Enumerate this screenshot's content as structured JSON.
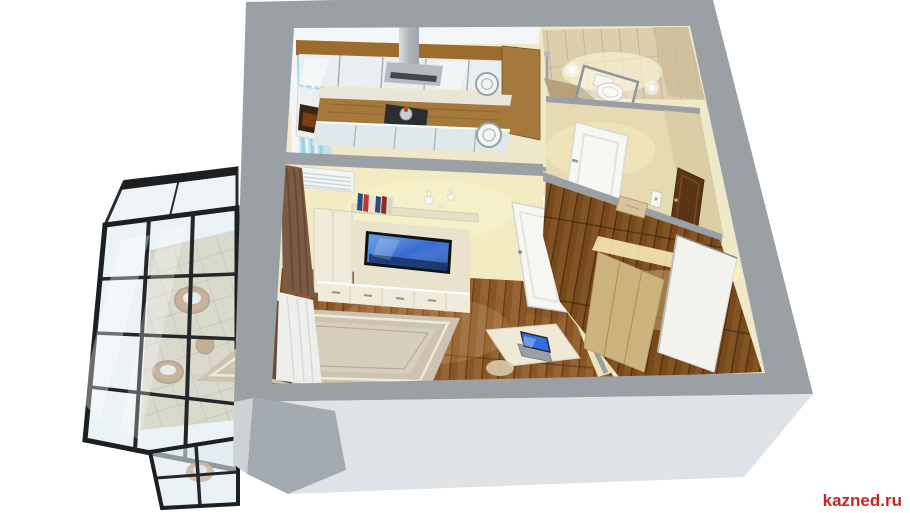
{
  "image": {
    "alt": "3D isometric cutaway render of a one-room apartment floor plan with kitchen, bathroom, hallway, living room and glazed balcony"
  },
  "watermark": {
    "text": "kazned.ru",
    "color": "#c5271d"
  },
  "palette": {
    "background": "#ffffff",
    "wall_top": "#9ba0a4",
    "wall_side": "#dfe3e5",
    "wall_side_mid": "#ccd2d5",
    "wall_side_dark": "#a4abb0",
    "interior_base": "#efe8c9",
    "living_wall": "#f3ecc3",
    "hall_wall": "#e6dab3",
    "floor_living": "#8a5526",
    "floor_hall": "#774819",
    "rug": "#cec3b0",
    "rug_inner": "#d8cec0",
    "cabinet_wood": "#9c6b2e",
    "counter_wood": "#a5783c",
    "cabinet_cream": "#f1ebdb",
    "unit_cream": "#e9e2cc",
    "steel": "#b4bcc0",
    "tv_screen": "#2a63cf",
    "laptop_screen": "#2f6fe0",
    "door_white": "#f7f7f4",
    "door_brown": "#5a3417",
    "wardrobe_beige": "#cdb47c",
    "wardrobe_white": "#f3f3ee",
    "curtain_brown": "#7d5a43",
    "curtain_white": "#edefed",
    "curtain_blue": "#bfe2ee",
    "bathroom_tile": "#ddcfae",
    "bathroom_floor": "#b29b74",
    "toilet_white": "#fbfbf9",
    "balcony_tile": "#d7c8a2",
    "glass": "#dce9ef",
    "frame_black": "#1d1f21",
    "rattan": "#b2713a",
    "glow_warm": "#fff3c0"
  },
  "scene": {
    "rooms": [
      {
        "name": "kitchen",
        "objects": [
          "upper-cabinets",
          "range-hood",
          "stove",
          "kettle",
          "oven",
          "base-cabinets",
          "sink",
          "window-curtain"
        ]
      },
      {
        "name": "bathroom",
        "objects": [
          "toilet",
          "glass-screen",
          "wall-sconces",
          "shower"
        ]
      },
      {
        "name": "hallway",
        "objects": [
          "bathroom-door",
          "entrance-door",
          "intercom",
          "pouf",
          "wardrobe"
        ]
      },
      {
        "name": "living-room",
        "objects": [
          "air-conditioner",
          "wall-shelf",
          "books",
          "vases",
          "tv",
          "tv-stand",
          "tall-cabinet",
          "curtains",
          "rug",
          "open-door",
          "desk",
          "laptop"
        ]
      },
      {
        "name": "balcony",
        "objects": [
          "glazing",
          "rattan-chairs",
          "side-table",
          "tile-floor"
        ]
      }
    ]
  }
}
